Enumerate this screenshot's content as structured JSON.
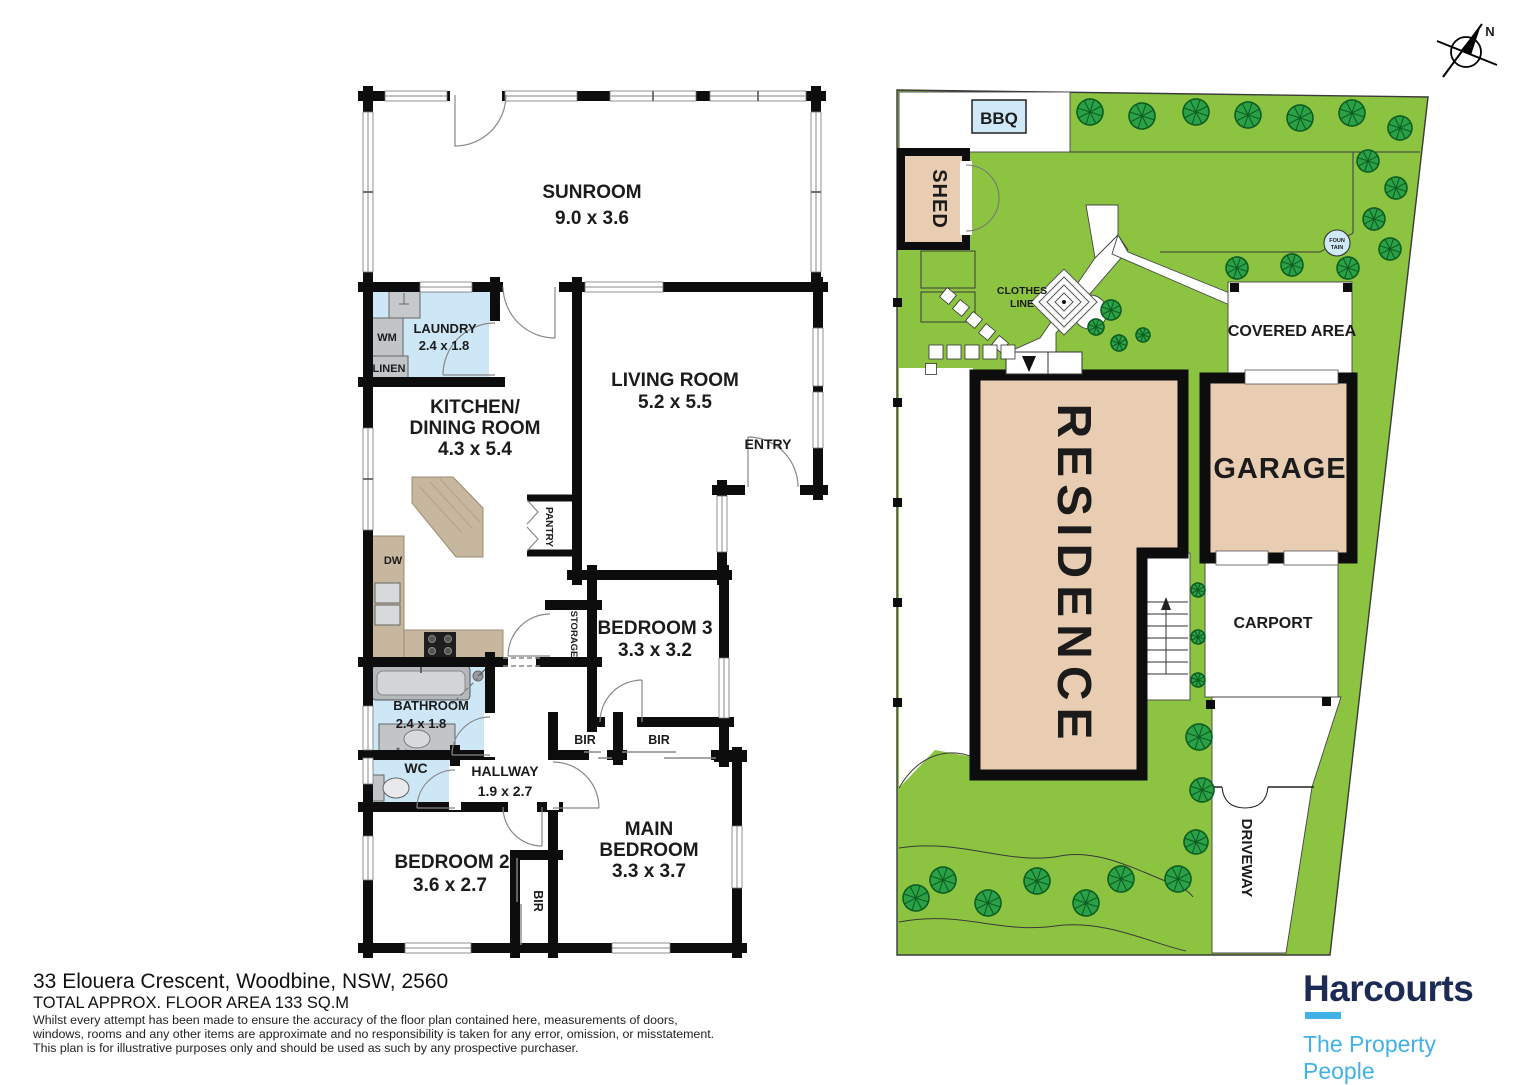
{
  "floorplan": {
    "sunroom": {
      "name": "SUNROOM",
      "dims": "9.0 x 3.6"
    },
    "laundry": {
      "name": "LAUNDRY",
      "dims": "2.4 x 1.8"
    },
    "kitchen_dining": {
      "name_line1": "KITCHEN/",
      "name_line2": "DINING ROOM",
      "dims": "4.3 x 5.4"
    },
    "living_room": {
      "name": "LIVING ROOM",
      "dims": "5.2 x 5.5"
    },
    "entry": {
      "name": "ENTRY"
    },
    "bedroom3": {
      "name": "BEDROOM 3",
      "dims": "3.3 x 3.2"
    },
    "bathroom": {
      "name": "BATHROOM",
      "dims": "2.4 x 1.8"
    },
    "wc": {
      "name": "WC"
    },
    "hallway": {
      "name": "HALLWAY",
      "dims": "1.9 x 2.7"
    },
    "bedroom2": {
      "name": "BEDROOM 2",
      "dims": "3.6 x 2.7"
    },
    "main_bedroom": {
      "name_line1": "MAIN",
      "name_line2": "BEDROOM",
      "dims": "3.3 x 3.7"
    },
    "fixtures": {
      "wm": "WM",
      "linen": "LINEN",
      "dw": "DW",
      "pantry": "PANTRY",
      "storage": "STORAGE",
      "bir": "BIR"
    }
  },
  "siteplan": {
    "bbq": "BBQ",
    "shed": "SHED",
    "clothes_line": {
      "line1": "CLOTHES",
      "line2": "LINE"
    },
    "fountain": {
      "line1": "FOUN",
      "line2": "TAIN"
    },
    "covered_area": "COVERED AREA",
    "residence": "RESIDENCE",
    "garage": "GARAGE",
    "carport": "CARPORT",
    "driveway": "DRIVEWAY",
    "compass_north": "N"
  },
  "footer": {
    "address": "33 Elouera Crescent, Woodbine, NSW, 2560",
    "floor_area": "TOTAL APPROX. FLOOR AREA 133 SQ.M",
    "disclaimer_line1": "Whilst every attempt has been made to ensure the accuracy of the floor plan contained here, measurements of doors,",
    "disclaimer_line2": "windows, rooms and any other items are approximate and no responsibility is taken for any error, omission, or misstatement.",
    "disclaimer_line3": "This plan is for illustrative purposes only and should be used as such by any prospective purchaser."
  },
  "brand": {
    "name": "Harcourts",
    "tagline": "The Property People",
    "navy": "#1c2a56",
    "light_blue": "#41b1e6"
  },
  "colors": {
    "wall": "#0d0d0d",
    "wet_area": "#cde7f7",
    "building": "#e9cdb2",
    "lawn": "#8cc441",
    "tree": "#2aa147",
    "counter": "#c7b79e"
  }
}
